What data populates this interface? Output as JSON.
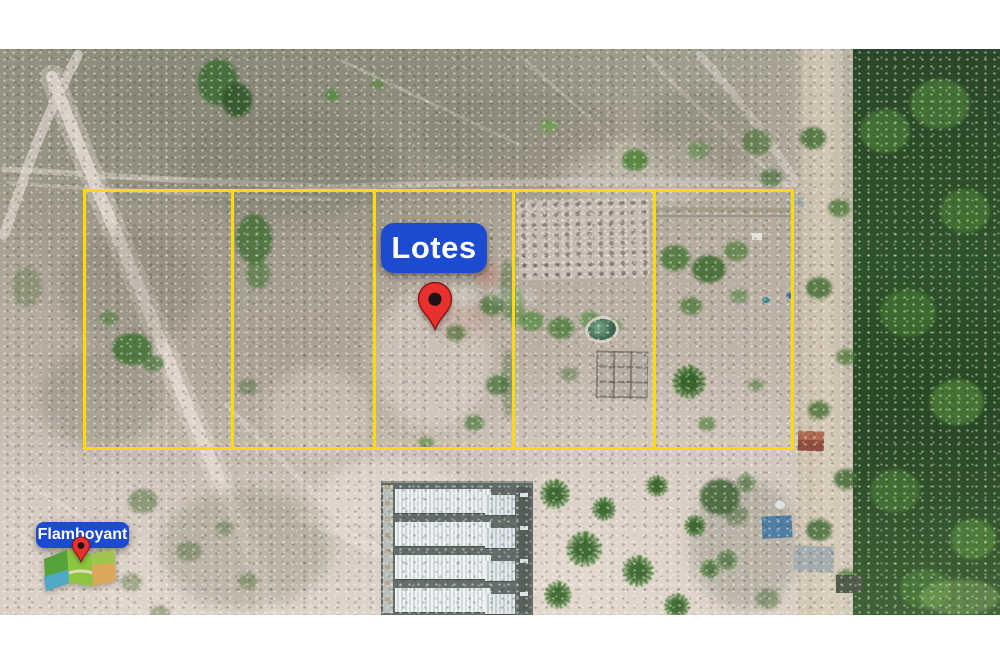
{
  "scene": {
    "type": "aerial-drone-photo",
    "description": "Top-down drone photograph of five demarcated sandy land lots outlined in yellow, scrub vegetation, dirt roads, a row of townhouses under construction at the bottom, palm trees, and a dense forest strip on the right edge",
    "letterbox_background": "#FFFFFF",
    "watermark_visible": true
  },
  "lot_grid": {
    "lot_count": 5,
    "line_color": "#FFDB00"
  },
  "lots_badge": {
    "label": "Lotes",
    "background": "#1C4AD0",
    "text_color": "#FFFFFF"
  },
  "location_pin": {
    "icon": "map-pin-icon",
    "fill": "#E8312E",
    "dot": "#1E1215"
  },
  "brand": {
    "label": "Flamboyant",
    "badge_background": "#1C4AD0",
    "text_color": "#FFFFFF",
    "map_icon": {
      "icon": "folded-map-icon",
      "lime": "#8CC63E",
      "green": "#55A33A",
      "teal": "#4FA8C5",
      "tan": "#D9A85C",
      "pin": "#E8312E"
    }
  }
}
